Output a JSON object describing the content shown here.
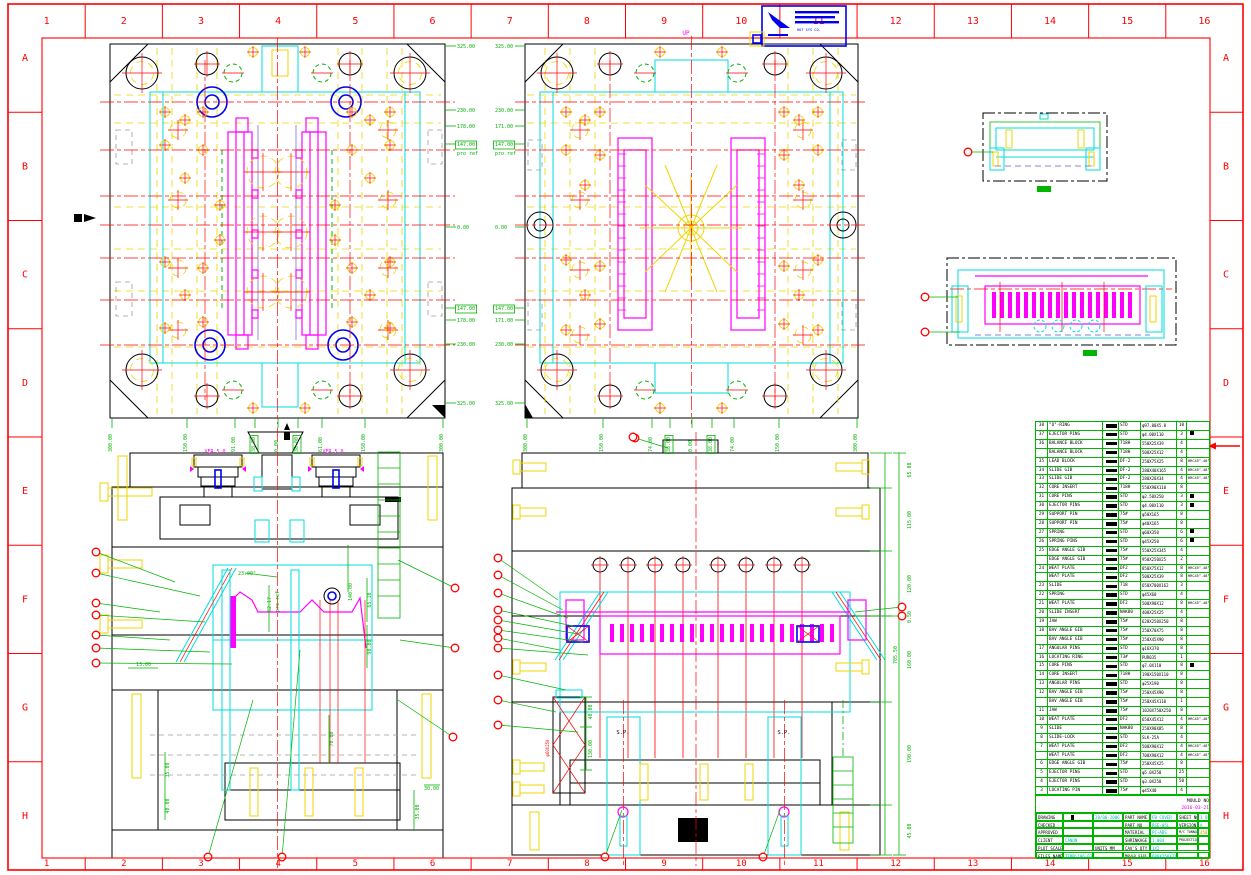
{
  "border": {
    "cols": [
      "1",
      "2",
      "3",
      "4",
      "5",
      "6",
      "7",
      "8",
      "9",
      "10",
      "11",
      "12",
      "13",
      "14",
      "15",
      "16"
    ],
    "rows": [
      "A",
      "B",
      "C",
      "D",
      "E",
      "F",
      "G",
      "H"
    ],
    "color": "#ff0000"
  },
  "stamp": {
    "company": "HOT SYS CO."
  },
  "annotations": [
    {
      "t": "325.00",
      "x": 457,
      "y": 48
    },
    {
      "t": "230.00",
      "x": 457,
      "y": 112
    },
    {
      "t": "178.00",
      "x": 457,
      "y": 128
    },
    {
      "t": "147.00",
      "x": 457,
      "y": 146,
      "b": true
    },
    {
      "t": "pro ref",
      "x": 457,
      "y": 155
    },
    {
      "t": "0.00",
      "x": 457,
      "y": 229
    },
    {
      "t": "147.00",
      "x": 457,
      "y": 310,
      "b": true
    },
    {
      "t": "178.00",
      "x": 457,
      "y": 322
    },
    {
      "t": "230.00",
      "x": 457,
      "y": 346
    },
    {
      "t": "325.00",
      "x": 457,
      "y": 405
    },
    {
      "t": "325.00",
      "x": 495,
      "y": 48
    },
    {
      "t": "230.00",
      "x": 495,
      "y": 112
    },
    {
      "t": "171.00",
      "x": 495,
      "y": 128
    },
    {
      "t": "147.00",
      "x": 495,
      "y": 146,
      "b": true
    },
    {
      "t": "pro ref",
      "x": 495,
      "y": 155
    },
    {
      "t": "0.00",
      "x": 495,
      "y": 229
    },
    {
      "t": "147.00",
      "x": 495,
      "y": 310,
      "b": true
    },
    {
      "t": "171.00",
      "x": 495,
      "y": 322
    },
    {
      "t": "230.00",
      "x": 495,
      "y": 346
    },
    {
      "t": "325.00",
      "x": 495,
      "y": 405
    },
    {
      "t": "300.00",
      "x": 112,
      "y": 452,
      "r": -90
    },
    {
      "t": "150.00",
      "x": 187,
      "y": 452,
      "r": -90
    },
    {
      "t": "91.00",
      "x": 235,
      "y": 452,
      "r": -90
    },
    {
      "t": "38.00",
      "x": 255,
      "y": 452,
      "r": -90,
      "b": true
    },
    {
      "t": "0.00",
      "x": 278,
      "y": 452,
      "r": -90
    },
    {
      "t": "38.00",
      "x": 298,
      "y": 452,
      "r": -90,
      "b": true
    },
    {
      "t": "61.00",
      "x": 322,
      "y": 452,
      "r": -90
    },
    {
      "t": "150.00",
      "x": 365,
      "y": 452,
      "r": -90
    },
    {
      "t": "300.00",
      "x": 443,
      "y": 452,
      "r": -90
    },
    {
      "t": "300.00",
      "x": 527,
      "y": 452,
      "r": -90
    },
    {
      "t": "150.00",
      "x": 603,
      "y": 452,
      "r": -90
    },
    {
      "t": "74.00",
      "x": 652,
      "y": 452,
      "r": -90
    },
    {
      "t": "38.00",
      "x": 670,
      "y": 452,
      "r": -90,
      "b": true
    },
    {
      "t": "0.00",
      "x": 692,
      "y": 452,
      "r": -90
    },
    {
      "t": "38.00",
      "x": 712,
      "y": 452,
      "r": -90,
      "b": true
    },
    {
      "t": "74.00",
      "x": 734,
      "y": 452,
      "r": -90
    },
    {
      "t": "150.00",
      "x": 779,
      "y": 452,
      "r": -90
    },
    {
      "t": "300.00",
      "x": 857,
      "y": 452,
      "r": -90
    },
    {
      "t": "UP",
      "x": 686,
      "y": 35,
      "c": "m",
      "fs": 6,
      "a": "middle"
    },
    {
      "t": "HOT SYS CO.",
      "x": 797,
      "y": 31,
      "c": "b",
      "fs": 3.6
    },
    {
      "t": "VER 5.0",
      "x": 215,
      "y": 453,
      "c": "m",
      "a": "middle",
      "fs": 5
    },
    {
      "t": "VER 5.0",
      "x": 333,
      "y": 453,
      "c": "m",
      "a": "middle",
      "fs": 5
    },
    {
      "t": "23.00°",
      "x": 238,
      "y": 575
    },
    {
      "t": "62.17",
      "x": 271,
      "y": 612,
      "r": -90
    },
    {
      "t": "pro ref",
      "x": 279,
      "y": 612,
      "r": -90
    },
    {
      "t": "140.00",
      "x": 352,
      "y": 592,
      "r": -90,
      "a": "middle"
    },
    {
      "t": "65.10",
      "x": 371,
      "y": 600,
      "r": -90,
      "a": "middle"
    },
    {
      "t": "90.00",
      "x": 371,
      "y": 647,
      "r": -90,
      "a": "middle"
    },
    {
      "t": "13.00",
      "x": 136,
      "y": 666
    },
    {
      "t": "70.00",
      "x": 333,
      "y": 739,
      "r": -90,
      "a": "middle"
    },
    {
      "t": "35.00",
      "x": 169,
      "y": 770,
      "r": -90,
      "a": "middle"
    },
    {
      "t": "40.00",
      "x": 169,
      "y": 806,
      "r": -90,
      "a": "middle"
    },
    {
      "t": "35.00",
      "x": 419,
      "y": 812,
      "r": -90,
      "a": "middle"
    },
    {
      "t": "30.00",
      "x": 424,
      "y": 790
    },
    {
      "t": "40.00",
      "x": 592,
      "y": 712,
      "r": -90,
      "a": "middle"
    },
    {
      "t": "130.00",
      "x": 592,
      "y": 749,
      "r": -90,
      "a": "middle"
    },
    {
      "t": "φ60X250",
      "x": 549,
      "y": 748,
      "r": -90,
      "c": "r",
      "fs": 4,
      "a": "middle"
    },
    {
      "t": "S.P.",
      "x": 623,
      "y": 734,
      "c": "k",
      "fs": 5.5,
      "a": "middle"
    },
    {
      "t": "S.P.",
      "x": 784,
      "y": 734,
      "c": "k",
      "fs": 5.5,
      "a": "middle"
    },
    {
      "t": "65.00",
      "x": 911,
      "y": 470,
      "r": -90,
      "a": "middle"
    },
    {
      "t": "115.00",
      "x": 911,
      "y": 520,
      "r": -90,
      "a": "middle"
    },
    {
      "t": "120.00",
      "x": 911,
      "y": 584,
      "r": -90,
      "a": "middle"
    },
    {
      "t": "0.50",
      "x": 911,
      "y": 617,
      "r": -90,
      "a": "middle"
    },
    {
      "t": "160.00",
      "x": 911,
      "y": 660,
      "r": -90,
      "a": "middle"
    },
    {
      "t": "190.00",
      "x": 911,
      "y": 754,
      "r": -90,
      "a": "middle"
    },
    {
      "t": "45.00",
      "x": 911,
      "y": 831,
      "r": -90,
      "a": "middle"
    },
    {
      "t": "705.50",
      "x": 897,
      "y": 655,
      "r": -90,
      "a": "middle"
    }
  ],
  "table": {
    "header": {
      "no": "NO",
      "desc": "DESCRIPTION",
      "mat": "MATERIAL",
      "size": "SIZE",
      "qty": "QTY",
      "rk": "REMARK"
    },
    "rows": [
      {
        "no": "38",
        "desc": "\"O\"-RING",
        "mat": "STD",
        "size": "φ97.00X5.8",
        "qty": "10",
        "rk": ""
      },
      {
        "no": "37",
        "desc": "EJECTOR PINS",
        "mat": "STD",
        "size": "φ4.00X110",
        "qty": "3",
        "rk": "sq"
      },
      {
        "no": "36",
        "desc": "BALANCE BLOCK",
        "mat": "718H",
        "size": "550X25X39",
        "qty": "4",
        "rk": ""
      },
      {
        "no": "",
        "desc": "BALANCE BLOCK",
        "mat": "718H",
        "size": "500X25X12",
        "qty": "4",
        "rk": ""
      },
      {
        "no": "35",
        "desc": "LEAD BLOCK",
        "mat": "DF-2",
        "size": "250X75X25",
        "qty": "8",
        "rk": "HRC45°-48°"
      },
      {
        "no": "34",
        "desc": "SLIDE GIB",
        "mat": "DF-2",
        "size": "280X40X165",
        "qty": "4",
        "rk": "HRC45°-48°"
      },
      {
        "no": "33",
        "desc": "SLIDE GIB",
        "mat": "DF-2",
        "size": "280X20X34",
        "qty": "4",
        "rk": "HRC45°-48°"
      },
      {
        "no": "32",
        "desc": "CORE INSERT",
        "mat": "718H",
        "size": "550X90X110",
        "qty": "8",
        "rk": ""
      },
      {
        "no": "31",
        "desc": "CORE PINS",
        "mat": "STD",
        "size": "φ2.50X250",
        "qty": "3",
        "rk": "sq"
      },
      {
        "no": "30",
        "desc": "EJECTOR PINS",
        "mat": "STD",
        "size": "φ4.00X110",
        "qty": "3",
        "rk": "sq"
      },
      {
        "no": "29",
        "desc": "SUPPORT PIN",
        "mat": "75#",
        "size": "φ50X165",
        "qty": "8",
        "rk": ""
      },
      {
        "no": "28",
        "desc": "SUPPORT PIN",
        "mat": "75#",
        "size": "φ40X165",
        "qty": "8",
        "rk": ""
      },
      {
        "no": "27",
        "desc": "SPRING",
        "mat": "STD",
        "size": "φ60X350",
        "qty": "6",
        "rk": "sq"
      },
      {
        "no": "26",
        "desc": "SPRING PINS",
        "mat": "STD",
        "size": "φ45X250",
        "qty": "6",
        "rk": "sq"
      },
      {
        "no": "25",
        "desc": "EDGE ANGLE GIB",
        "mat": "75#",
        "size": "550X25X345",
        "qty": "4",
        "rk": ""
      },
      {
        "no": "",
        "desc": "EDGE ANGLE GIB",
        "mat": "75#",
        "size": "950X250X25",
        "qty": "2",
        "rk": ""
      },
      {
        "no": "24",
        "desc": "WEAT PLATE",
        "mat": "DF2",
        "size": "850X75X12",
        "qty": "8",
        "rk": "HRC45°-48°"
      },
      {
        "no": "",
        "desc": "WEAT PLATE",
        "mat": "DF2",
        "size": "500X25X39",
        "qty": "8",
        "rk": "HRC45°-48°"
      },
      {
        "no": "23",
        "desc": "SLIDE",
        "mat": "718",
        "size": "650X700X162",
        "qty": "3",
        "rk": ""
      },
      {
        "no": "22",
        "desc": "SPRING",
        "mat": "STD",
        "size": "φ45X60",
        "qty": "4",
        "rk": ""
      },
      {
        "no": "21",
        "desc": "WEAT PLATE",
        "mat": "DF2",
        "size": "500X90X12",
        "qty": "8",
        "rk": "HRC45°-48°"
      },
      {
        "no": "20",
        "desc": "SLIDE INSERT",
        "mat": "NAK80",
        "size": "400X25X25",
        "qty": "4",
        "rk": ""
      },
      {
        "no": "19",
        "desc": "JAW",
        "mat": "75#",
        "size": "620X250X250",
        "qty": "8",
        "rk": ""
      },
      {
        "no": "18",
        "desc": "BAV ANGLE GIB",
        "mat": "75#",
        "size": "250X70X75",
        "qty": "8",
        "rk": ""
      },
      {
        "no": "",
        "desc": "BAV ANGLE GIB",
        "mat": "75#",
        "size": "250X45X90",
        "qty": "8",
        "rk": ""
      },
      {
        "no": "17",
        "desc": "ANGULAR PINS",
        "mat": "STD",
        "size": "φ16X370",
        "qty": "8",
        "rk": ""
      },
      {
        "no": "16",
        "desc": "LOCATING RING",
        "mat": "73#",
        "size": "PUR035",
        "qty": "1",
        "rk": ""
      },
      {
        "no": "15",
        "desc": "CORE PINS",
        "mat": "STD",
        "size": "φ7.0X110",
        "qty": "8",
        "rk": "sq"
      },
      {
        "no": "14",
        "desc": "CORE INSERT",
        "mat": "718H",
        "size": "190X150X110",
        "qty": "8",
        "rk": ""
      },
      {
        "no": "13",
        "desc": "ANGULAR PINS",
        "mat": "STD",
        "size": "φ25X190",
        "qty": "8",
        "rk": ""
      },
      {
        "no": "12",
        "desc": "BAV ANGLE GIB",
        "mat": "75#",
        "size": "250X45X90",
        "qty": "8",
        "rk": ""
      },
      {
        "no": "",
        "desc": "BAV ANGLE GIB",
        "mat": "75#",
        "size": "250X45X110",
        "qty": "1",
        "rk": ""
      },
      {
        "no": "11",
        "desc": "JAW",
        "mat": "75#",
        "size": "1020X750X250",
        "qty": "8",
        "rk": ""
      },
      {
        "no": "10",
        "desc": "WEAT PLATE",
        "mat": "DF2",
        "size": "650X45X12",
        "qty": "4",
        "rk": "HRC45°-48°"
      },
      {
        "no": "9",
        "desc": "SLIDE",
        "mat": "NAK80",
        "size": "250X90X85",
        "qty": "8",
        "rk": ""
      },
      {
        "no": "8",
        "desc": "SLIDE-LOCK",
        "mat": "STD",
        "size": "SLK-25A",
        "qty": "4",
        "rk": ""
      },
      {
        "no": "7",
        "desc": "WEAT PLATE",
        "mat": "DF2",
        "size": "500X90X12",
        "qty": "4",
        "rk": "HRC45°-48°"
      },
      {
        "no": "",
        "desc": "WEAT PLATE",
        "mat": "DF2",
        "size": "700X90X12",
        "qty": "4",
        "rk": "HRC45°-48°"
      },
      {
        "no": "6",
        "desc": "EDGE ANGLE GIB",
        "mat": "75#",
        "size": "250X45X25",
        "qty": "8",
        "rk": ""
      },
      {
        "no": "5",
        "desc": "EJECTOR PINS",
        "mat": "STD",
        "size": "φ5.0X250",
        "qty": "25",
        "rk": ""
      },
      {
        "no": "4",
        "desc": "EJECTOR PINS",
        "mat": "STD",
        "size": "φ3.0X250",
        "qty": "50",
        "rk": ""
      },
      {
        "no": "3",
        "desc": "LOCATING PIN",
        "mat": "75#",
        "size": "φ45X40",
        "qty": "4",
        "rk": ""
      },
      {
        "no": "2",
        "desc": "CORE",
        "mat": "738H",
        "size": "1500X450X110",
        "qty": "8",
        "rk": ""
      },
      {
        "no": "1",
        "desc": "CAVITY",
        "mat": "NAK80",
        "size": "1500X450X70",
        "qty": "8",
        "rk": ""
      },
      {
        "no": "",
        "desc": "MOLD BASE",
        "mat": "",
        "size": "6045 A135 2550 C150",
        "qty": "",
        "rk": "LKM"
      }
    ]
  },
  "titleblock": {
    "mold_no_label": "MOULD NO",
    "mold_no": "2016-03-21",
    "rows": [
      {
        "l": "DRAWING",
        "v1": "",
        "v2": "28/08-2006",
        "l2": "PART NAME",
        "v3": "FB COVER",
        "l3": "SHEET NO",
        "v4": "1 OF 1",
        "bar": true
      },
      {
        "l": "CHECKED",
        "v1": "",
        "v2": "",
        "l2": "PART NO",
        "v3": "RSE-05L",
        "l3": "VERSION",
        "v4": "A"
      },
      {
        "l": "APPROVED",
        "v1": "",
        "v2": "",
        "l2": "MATERIAL",
        "v3": "PC+ABS",
        "l3": "M/C TONNAGE",
        "v4": "450T",
        "v4c": "o"
      },
      {
        "l": "CLIENT",
        "v1": "CANON",
        "v2": "",
        "l2": "SHRINKAGE",
        "v3": "1.004",
        "l3": "PROJECTION",
        "v4": ""
      },
      {
        "l": "PLOT SCALE",
        "v1": "",
        "v2": "UNITS MM",
        "l2": "CAV'S QTY",
        "v3": "1X2",
        "l3": "",
        "v4": ""
      },
      {
        "l": "FILES NAME",
        "v1": "TEMP\\I06-03-21",
        "v2": "",
        "l2": "MOULD SIZE",
        "v3": "600X250X718",
        "l3": "",
        "v4": ""
      }
    ]
  },
  "colors": {
    "green": "#00b400",
    "magenta": "#ff00ff",
    "cyan": "#00dede",
    "yellow": "#efd600",
    "red": "#ff0000",
    "blue": "#0000ee",
    "orange": "#e09000"
  }
}
